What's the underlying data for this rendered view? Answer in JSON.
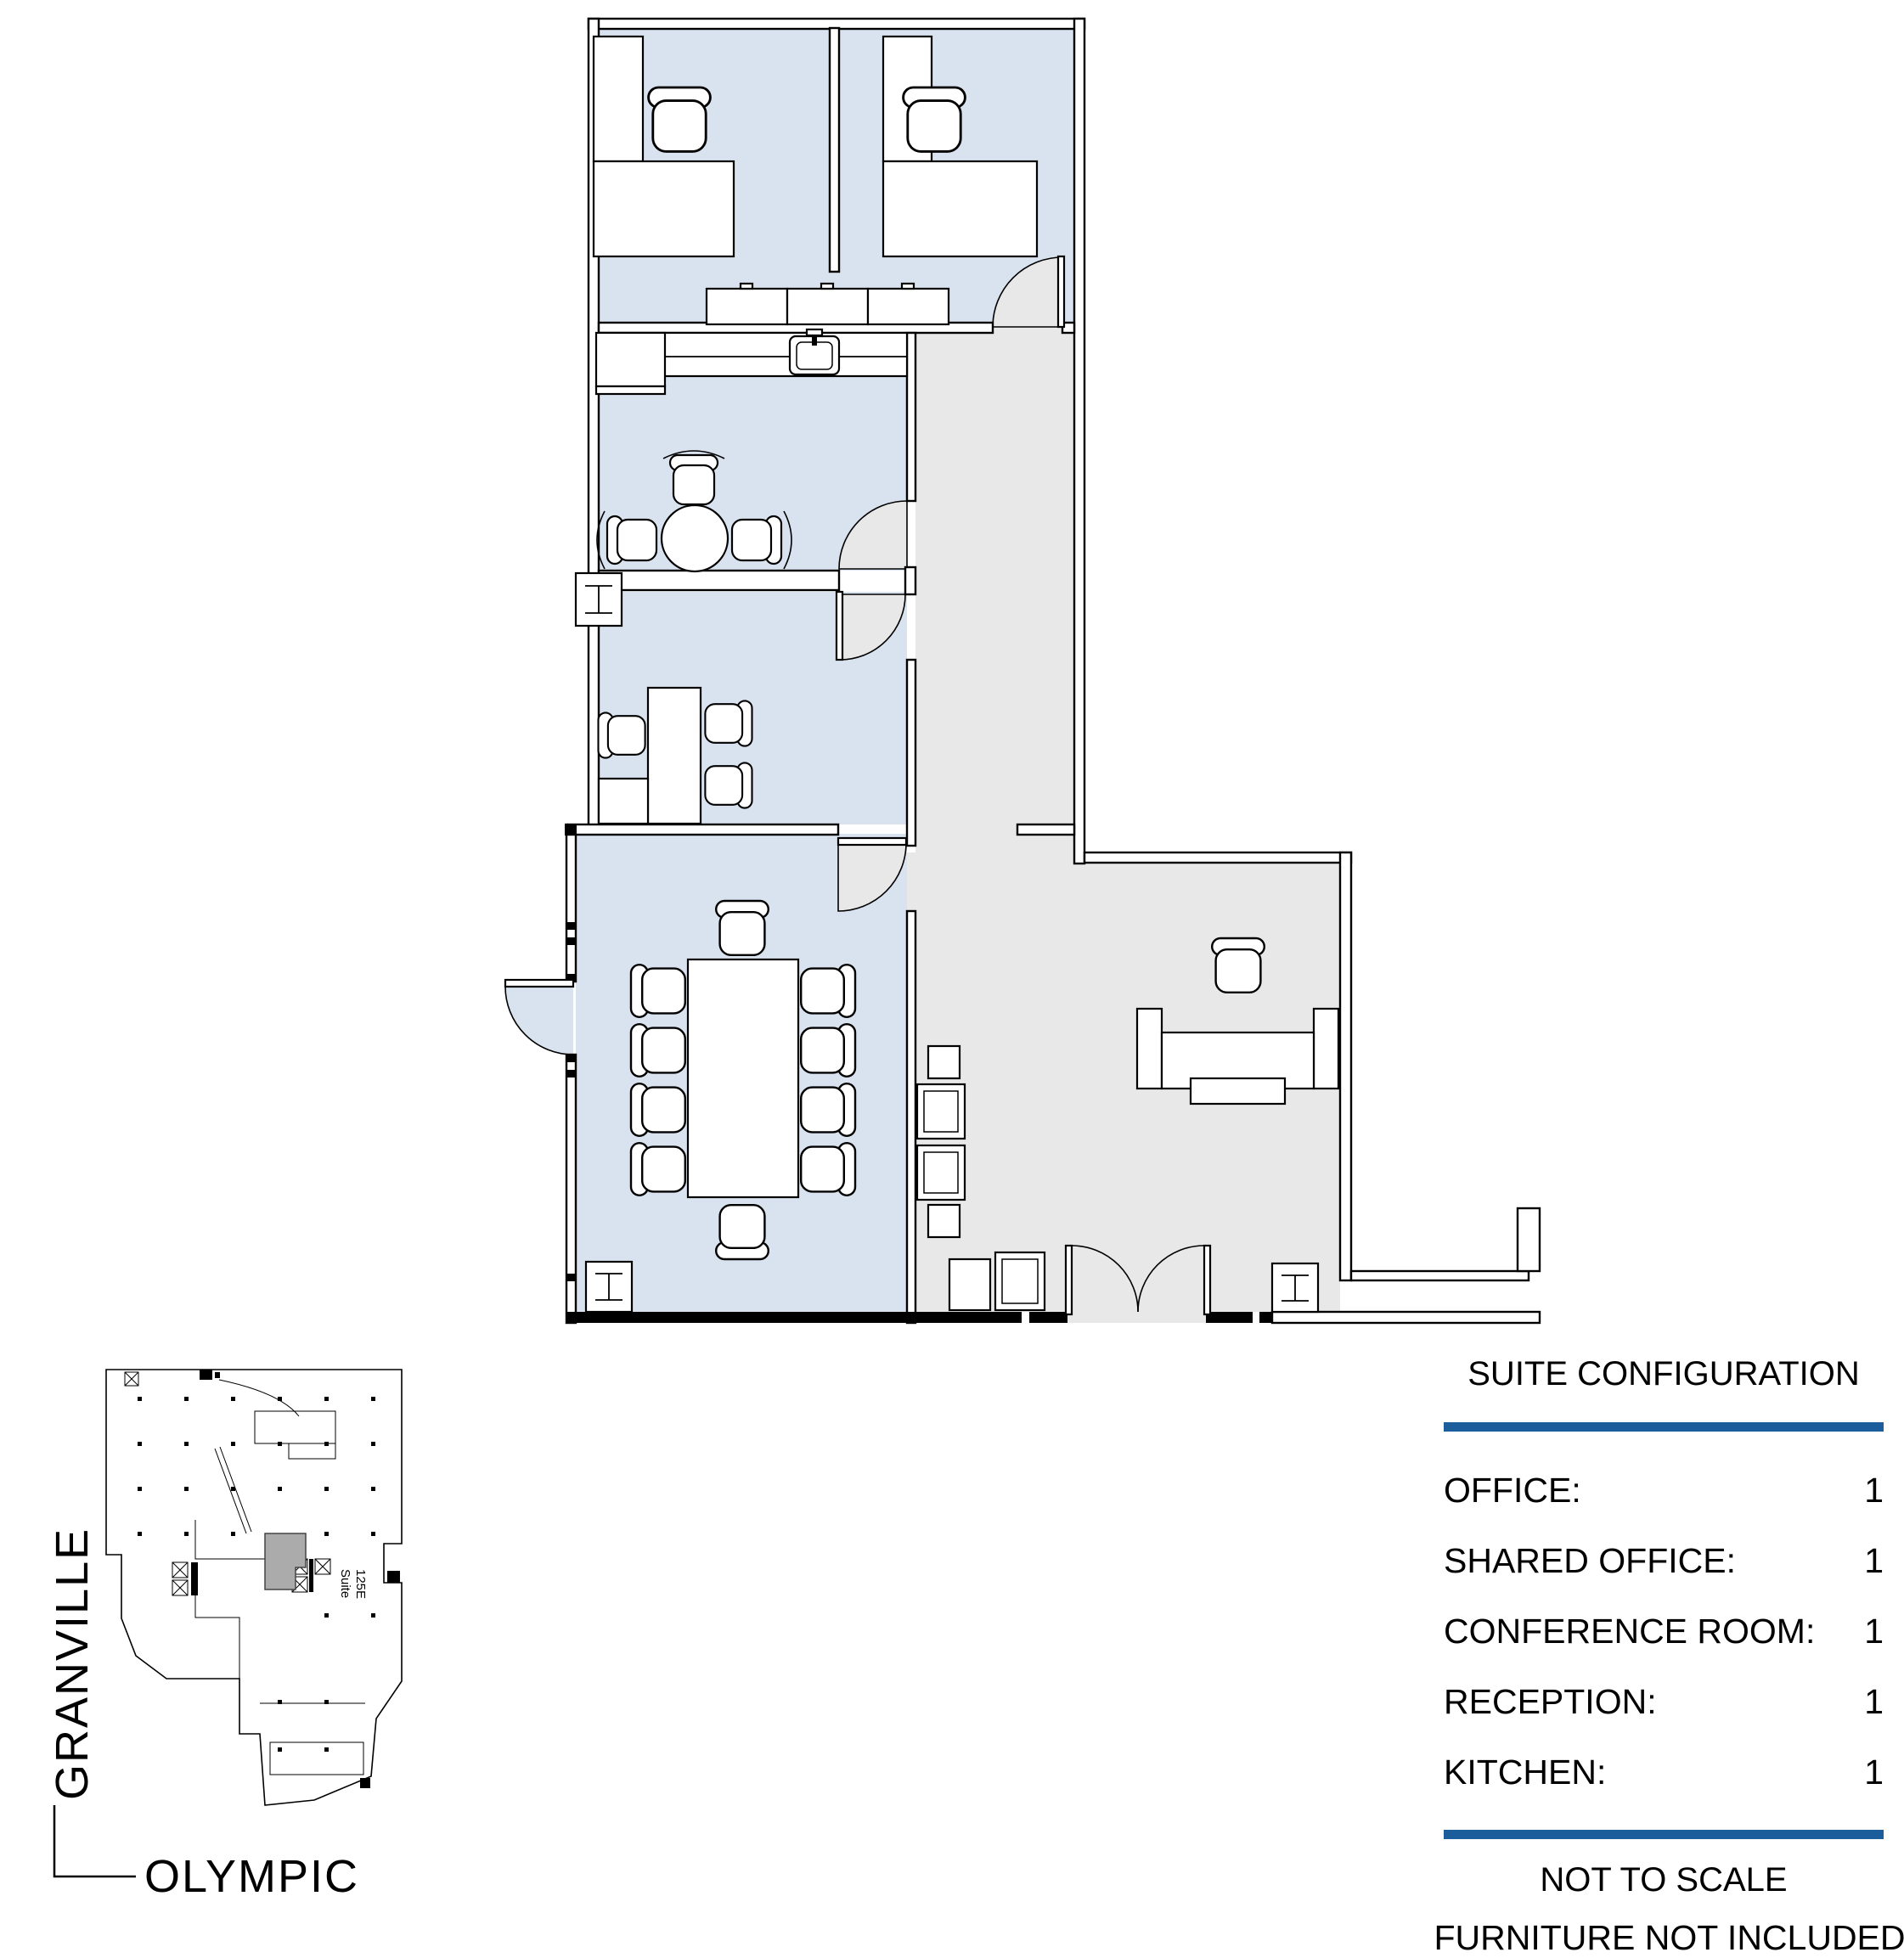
{
  "legend": {
    "title": "SUITE CONFIGURATION",
    "rows": [
      {
        "label": "OFFICE:",
        "value": "1"
      },
      {
        "label": "SHARED OFFICE:",
        "value": "1"
      },
      {
        "label": "CONFERENCE ROOM:",
        "value": "1"
      },
      {
        "label": "RECEPTION:",
        "value": "1"
      },
      {
        "label": "KITCHEN:",
        "value": "1"
      }
    ],
    "notes": [
      "NOT TO SCALE",
      "FURNITURE NOT INCLUDED"
    ],
    "accent_color": "#1b5e9b"
  },
  "locator_map": {
    "street_vertical": "GRANVILLE",
    "street_horizontal": "OLYMPIC",
    "suite_label_line1": "Suite",
    "suite_label_line2": "125E"
  },
  "plan": {
    "colors": {
      "room_fill": "#d9e2ef",
      "common_fill": "#e8e8e8",
      "wall_line": "#000000",
      "locator_suite_fill": "#ababab"
    },
    "rooms": [
      "shared-office",
      "kitchen",
      "office",
      "conference-room",
      "reception",
      "corridor"
    ]
  }
}
